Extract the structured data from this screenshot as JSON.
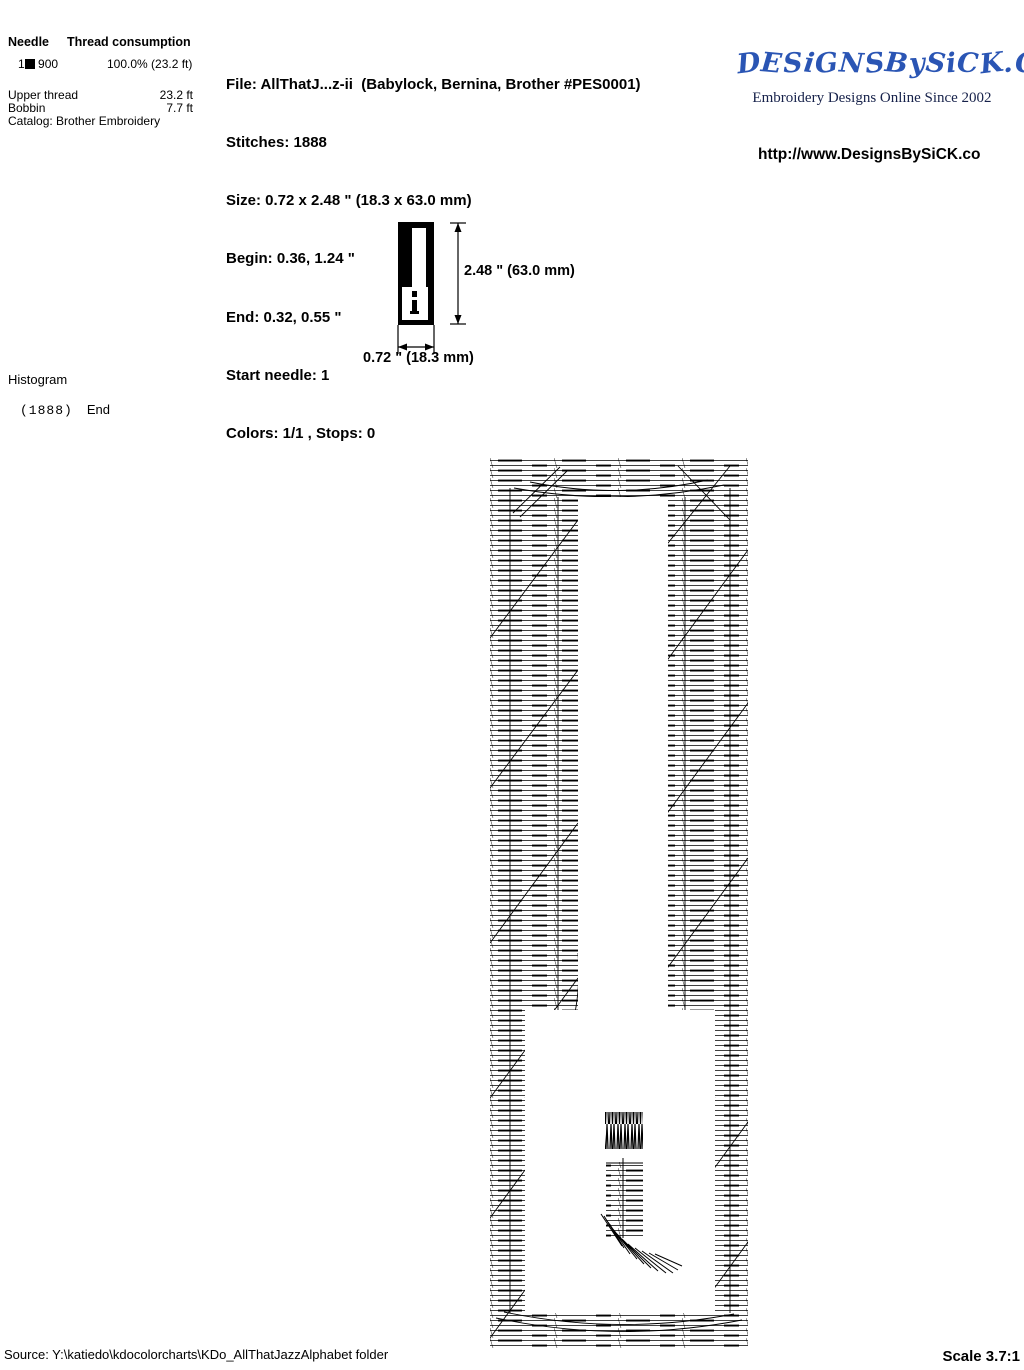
{
  "thread_table": {
    "needle_header": "Needle",
    "consumption_header": "Thread consumption",
    "needle_number": "1",
    "color_code": "900",
    "usage": "100.0% (23.2 ft)",
    "upper_thread_label": "Upper thread",
    "upper_thread_value": "23.2 ft",
    "bobbin_label": "Bobbin",
    "bobbin_value": "7.7 ft",
    "catalog": "Catalog: Brother Embroidery",
    "swatch_color": "#000000"
  },
  "file_info": {
    "file": "File: AllThatJ...z-ii  (Babylock, Bernina, Brother #PES0001)",
    "stitches": "Stitches: 1888",
    "size": "Size: 0.72 x 2.48 \" (18.3 x 63.0 mm)",
    "begin": "Begin: 0.36, 1.24 \"",
    "end": "End: 0.32, 0.55 \"",
    "start_needle": "Start needle: 1",
    "colors": "Colors: 1/1 , Stops: 0"
  },
  "branding": {
    "logo_text": "DESiGNSBySiCK.COM",
    "tagline": "Embroidery Designs Online Since 2002",
    "url": "http://www.DesignsBySiCK.co",
    "logo_color": "#2a55b4"
  },
  "dimensions": {
    "height_label": "2.48 \" (63.0 mm)",
    "width_label": "0.72 \" (18.3 mm)"
  },
  "histogram": {
    "title": "Histogram",
    "count": "(1888)",
    "end_label": "End"
  },
  "footer": {
    "source": "Source: Y:\\katiedo\\kdocolorcharts\\KDo_AllThatJazzAlphabet folder",
    "scale": "Scale 3.7:1"
  }
}
